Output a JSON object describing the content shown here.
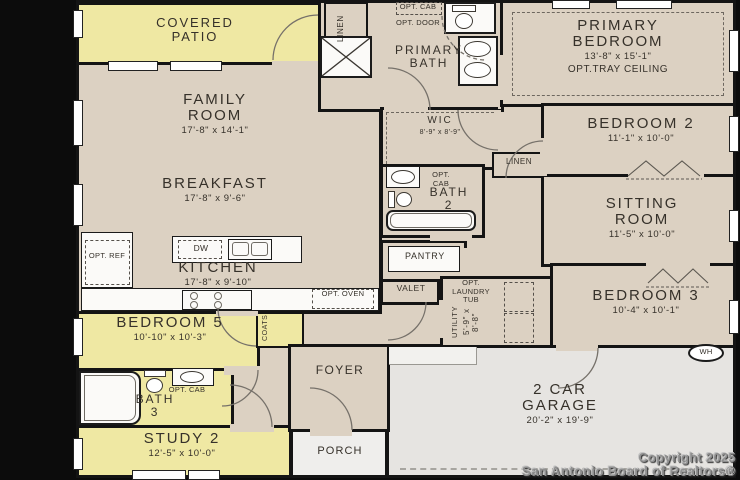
{
  "meta": {
    "copyright_line1": "Copyright 2025",
    "copyright_line2": "San Antonio Board of Realtors®"
  },
  "colors": {
    "patio_yellow": "#efe8a3",
    "room_beige": "#dcd1c2",
    "garage_gray": "#e6e4e1",
    "wall_black": "#141414"
  },
  "rooms": {
    "covered_patio": {
      "name": "COVERED PATIO"
    },
    "family_room": {
      "name": "FAMILY ROOM",
      "dims": "17'-8\" x 14'-1\""
    },
    "breakfast": {
      "name": "BREAKFAST",
      "dims": "17'-8\" x 9'-6\""
    },
    "kitchen": {
      "name": "KITCHEN",
      "dims": "17'-8\" x 9'-10\""
    },
    "primary_bedroom": {
      "name": "PRIMARY BEDROOM",
      "dims": "13'-8\" x 15'-1\"",
      "note": "OPT.TRAY CEILING"
    },
    "primary_bath": {
      "name": "PRIMARY BATH"
    },
    "linen_top": {
      "name": "LINEN"
    },
    "opt_cab_top": {
      "name": "OPT. CAB"
    },
    "opt_door": {
      "name": "OPT. DOOR"
    },
    "wic": {
      "name": "WIC",
      "dims": "8'-9\" x 8'-9\""
    },
    "linen_hall": {
      "name": "LINEN"
    },
    "bath_2": {
      "name": "BATH 2",
      "opt_cab": "OPT. CAB"
    },
    "bedroom_2": {
      "name": "BEDROOM 2",
      "dims": "11'-1\" x 10'-0\""
    },
    "sitting_room": {
      "name": "SITTING ROOM",
      "dims": "11'-5\" x 10'-0\""
    },
    "bedroom_3": {
      "name": "BEDROOM 3",
      "dims": "10'-4\" x 10'-1\""
    },
    "pantry": {
      "name": "PANTRY"
    },
    "valet": {
      "name": "VALET"
    },
    "utility": {
      "name": "UTILITY",
      "dims": "5'-9\" x 8'-8\"",
      "opt": "OPT. LAUNDRY TUB"
    },
    "bedroom_5": {
      "name": "BEDROOM 5",
      "dims": "10'-10\" x 10'-3\""
    },
    "bath_3": {
      "name": "BATH 3",
      "opt_cab": "OPT. CAB"
    },
    "coats": {
      "name": "COATS"
    },
    "study_2": {
      "name": "STUDY 2",
      "dims": "12'-5\" x 10'-0\""
    },
    "foyer": {
      "name": "FOYER"
    },
    "porch": {
      "name": "PORCH"
    },
    "garage": {
      "name": "2 CAR GARAGE",
      "dims": "20'-2\" x 19'-9\""
    },
    "water_heater": {
      "name": "WH"
    }
  },
  "appliances": {
    "dw": "DW",
    "opt_ref": "OPT. REF",
    "opt_oven": "OPT. OVEN"
  }
}
